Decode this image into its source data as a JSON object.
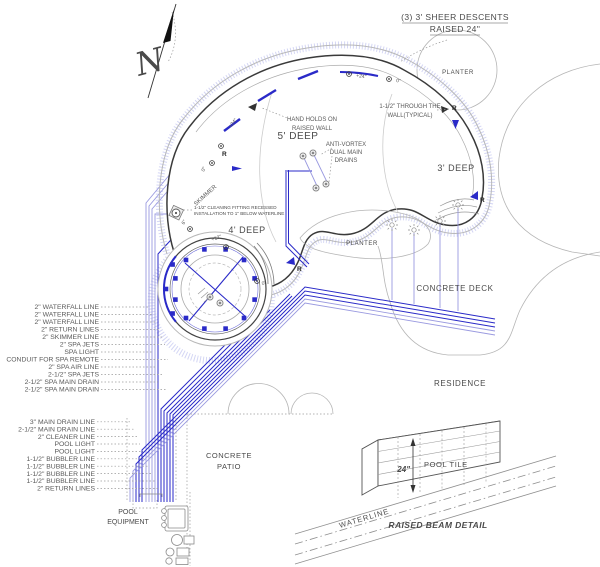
{
  "north": {
    "letter": "N"
  },
  "header": {
    "line1": "(3) 3' SHEER DESCENTS",
    "line2": "RAISED 24\""
  },
  "pool": {
    "depth_5": "5' DEEP",
    "depth_4": "4' DEEP",
    "depth_3": "3' DEEP",
    "hand_holds_1": "HAND HOLDS ON",
    "hand_holds_2": "RAISED WALL",
    "anti_vortex_1": "ANTI-VORTEX",
    "anti_vortex_2": "DUAL MAIN",
    "anti_vortex_3": "DRAINS",
    "through_wall_1": "1-1/2\" THROUGH THE",
    "through_wall_2": "WALL(TYPICAL)",
    "cleaning_1": "1-1/2\" CLEANING FITTING RECESSED",
    "cleaning_2": "INSTALLATION TO 1\" BELOW WATERLINE",
    "skimmer": "SKIMMER",
    "marks": {
      "plus24": "+24\"",
      "zero": "0\"",
      "plus12": "+12\"",
      "six": "6\"",
      "r": "R"
    }
  },
  "site": {
    "planter": "PLANTER",
    "concrete_deck": "CONCRETE DECK",
    "residence": "RESIDENCE",
    "patio_1": "CONCRETE",
    "patio_2": "PATIO",
    "equipment_1": "POOL",
    "equipment_2": "EQUIPMENT"
  },
  "spa_pool_lines": [
    "2\" WATERFALL LINE",
    "2\" WATERFALL LINE",
    "2\" WATERFALL LINE",
    "2\" RETURN LINES",
    "2\" SKIMMER LINE",
    "2\" SPA JETS",
    "SPA LIGHT",
    "CONDUIT FOR SPA REMOTE",
    "2\" SPA AIR LINE",
    "2-1/2\" SPA JETS",
    "2-1/2\" SPA MAIN DRAIN",
    "2-1/2\" SPA MAIN DRAIN"
  ],
  "pool_lines": [
    "3\" MAIN DRAIN LINE",
    "2-1/2\" MAIN DRAIN LINE",
    "2\" CLEANER LINE",
    "POOL LIGHT",
    "POOL LIGHT",
    "1-1/2\" BUBBLER LINE",
    "1-1/2\" BUBBLER LINE",
    "1-1/2\" BUBBLER LINE",
    "1-1/2\" BUBBLER LINE",
    "2\" RETURN LINES"
  ],
  "detail": {
    "pool_tile": "POOL TILE",
    "height": "24\"",
    "waterline": "WATERLINE",
    "title": "RAISED BEAM DETAIL"
  },
  "colors": {
    "pipe_blue": "#2a2ac8",
    "pipe_lavender": "#9a9ae0",
    "wall_dark": "#3a3a3a",
    "text_gray": "#4a4a4a"
  }
}
